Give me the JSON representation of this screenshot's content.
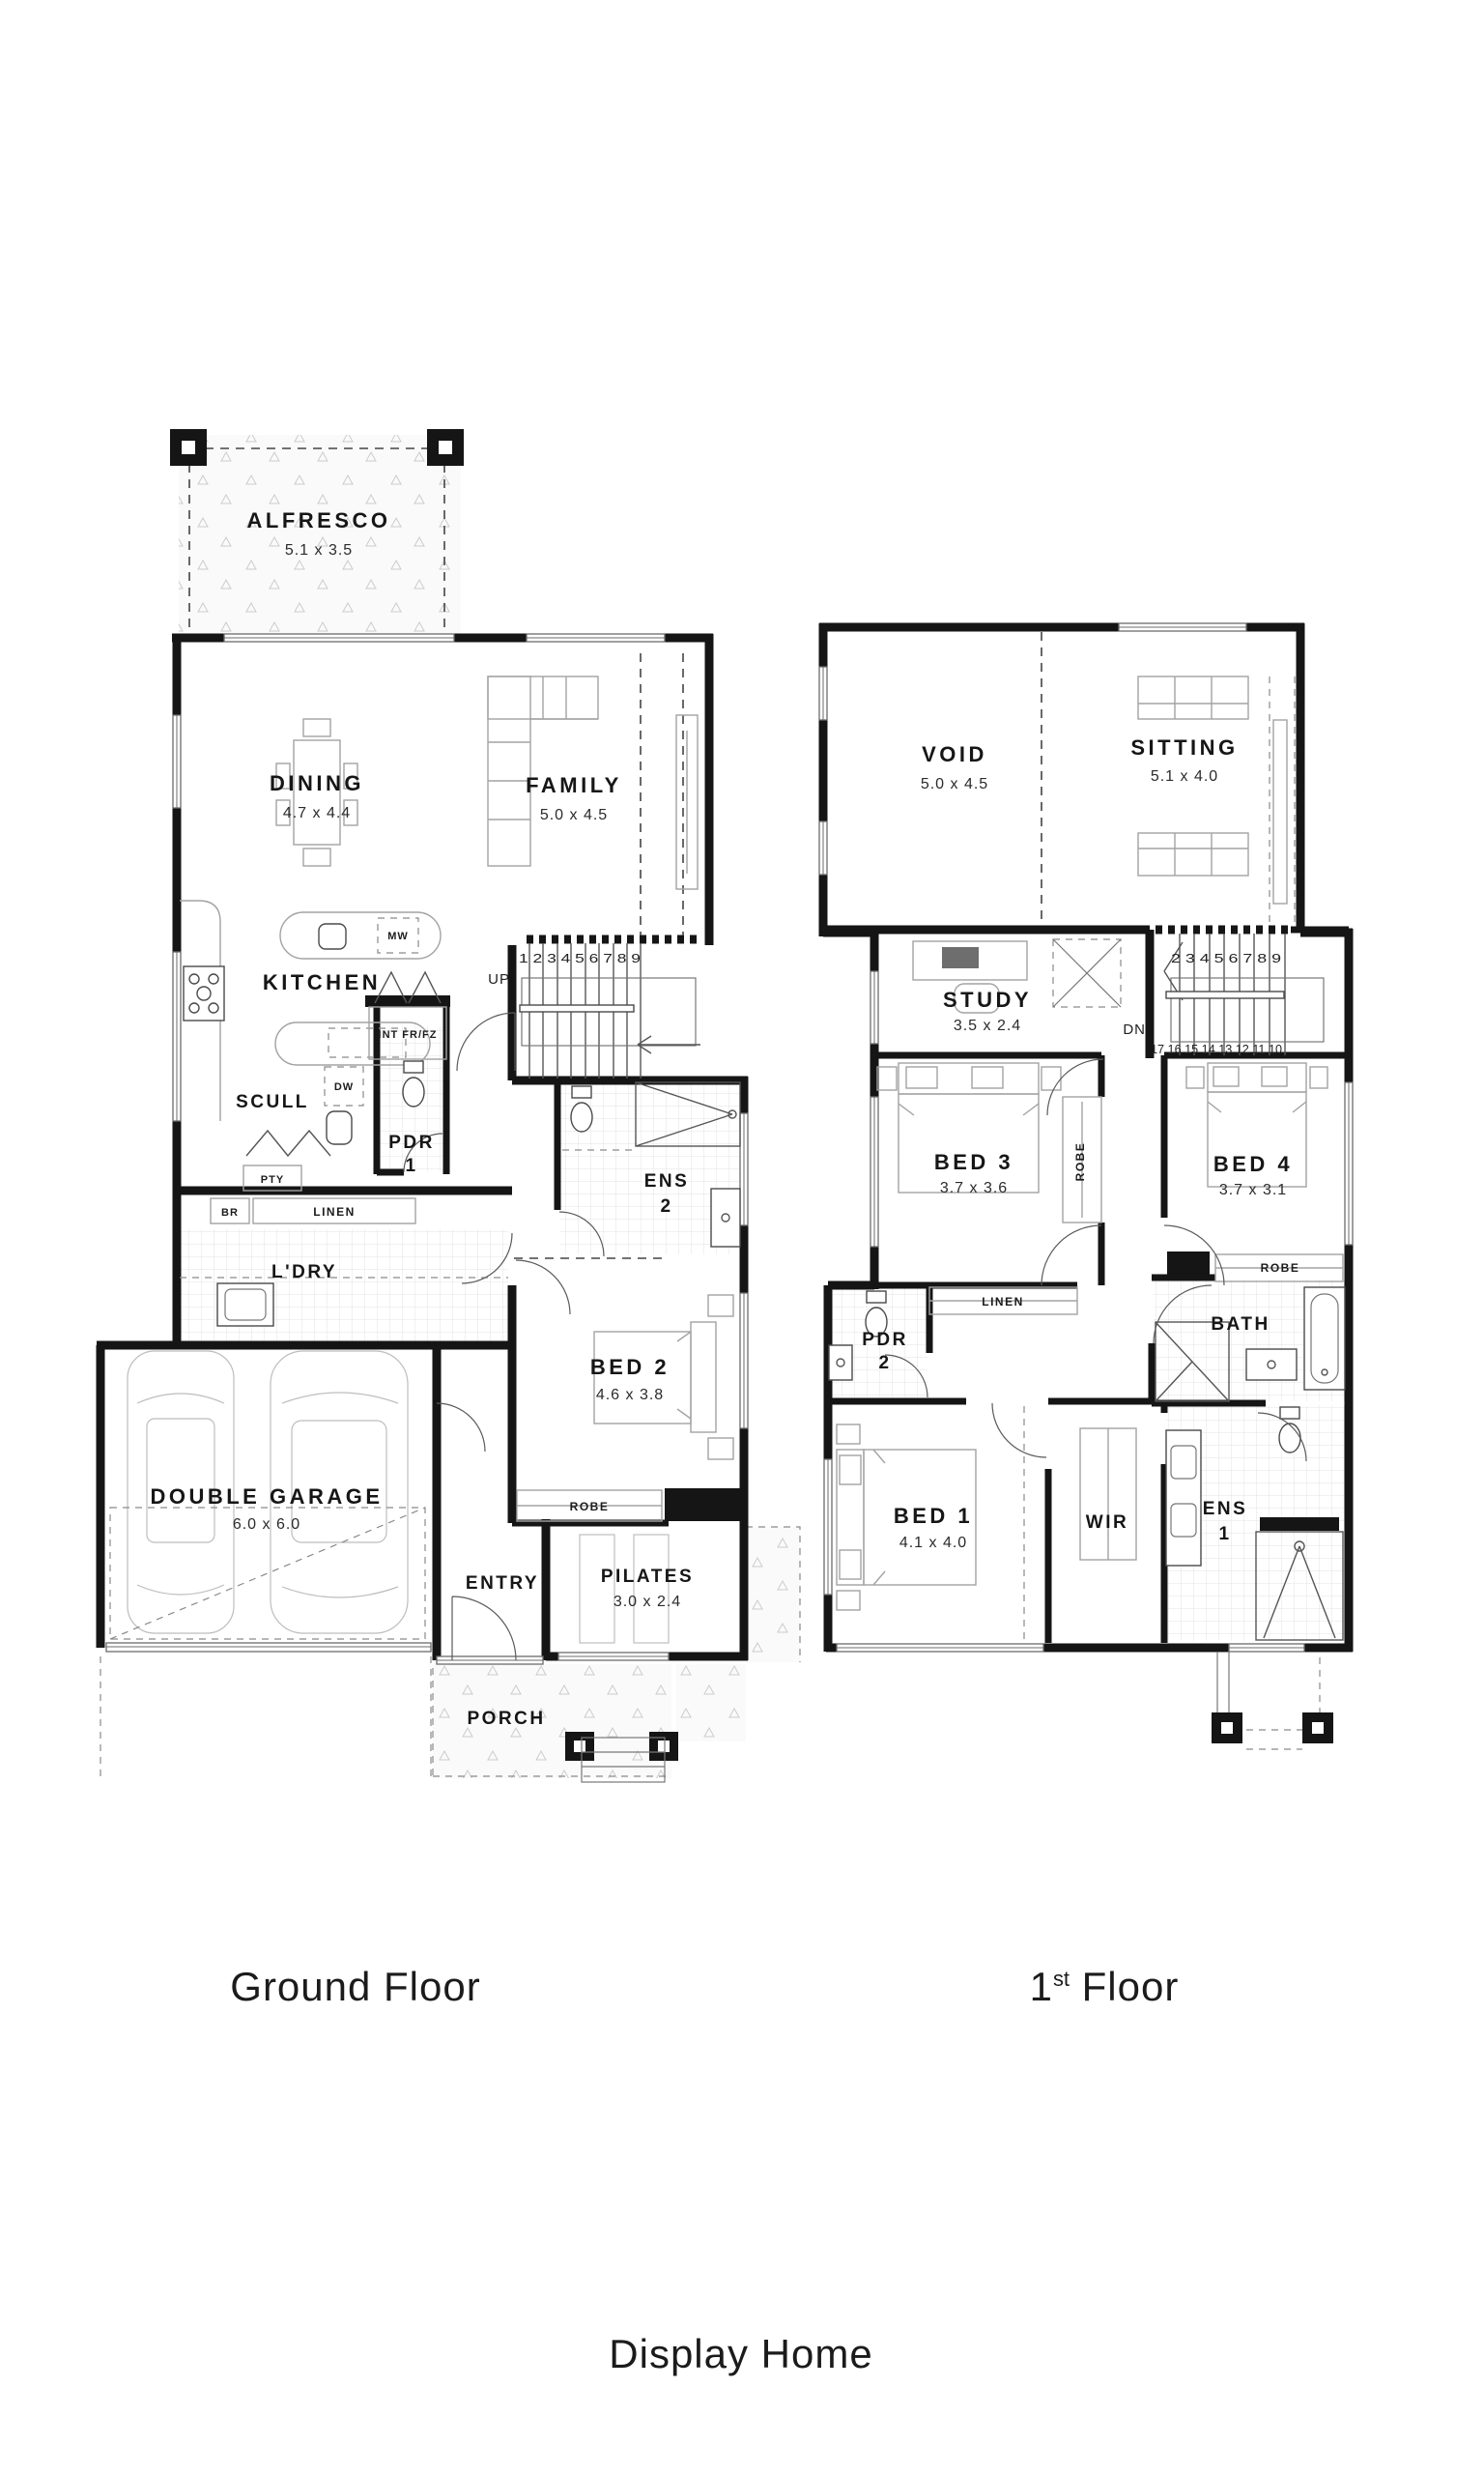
{
  "ground_floor": {
    "caption": "Ground Floor",
    "rooms": {
      "alfresco": {
        "name": "ALFRESCO",
        "dims": "5.1 x 3.5"
      },
      "dining": {
        "name": "DINING",
        "dims": "4.7 x 4.4"
      },
      "family": {
        "name": "FAMILY",
        "dims": "5.0 x 4.5"
      },
      "kitchen": {
        "name": "KITCHEN"
      },
      "scull": {
        "name": "SCULL"
      },
      "pdr1": {
        "name": "PDR",
        "number": "1"
      },
      "ens2": {
        "name": "ENS",
        "number": "2"
      },
      "ldry": {
        "name": "L'DRY"
      },
      "bed2": {
        "name": "BED 2",
        "dims": "4.6 x 3.8"
      },
      "garage": {
        "name": "DOUBLE GARAGE",
        "dims": "6.0 x 6.0"
      },
      "entry": {
        "name": "ENTRY"
      },
      "pilates": {
        "name": "PILATES",
        "dims": "3.0 x 2.4"
      },
      "porch": {
        "name": "PORCH"
      }
    },
    "fixtures": {
      "mw": "MW",
      "dw": "DW",
      "int_fridge": "INT FR/FZ",
      "pty": "PTY",
      "br": "BR",
      "linen": "LINEN",
      "robe": "ROBE"
    },
    "stairs": {
      "direction": "UP",
      "treads": "1 2 3 4 5 6 7 8 9"
    }
  },
  "first_floor": {
    "caption_number": "1",
    "caption_ordinal": "st",
    "caption_word": "Floor",
    "rooms": {
      "void": {
        "name": "VOID",
        "dims": "5.0 x 4.5"
      },
      "sitting": {
        "name": "SITTING",
        "dims": "5.1 x 4.0"
      },
      "study": {
        "name": "STUDY",
        "dims": "3.5 x 2.4"
      },
      "bed3": {
        "name": "BED 3",
        "dims": "3.7 x 3.6"
      },
      "bed4": {
        "name": "BED 4",
        "dims": "3.7 x 3.1"
      },
      "bath": {
        "name": "BATH"
      },
      "pdr2": {
        "name": "PDR",
        "number": "2"
      },
      "bed1": {
        "name": "BED 1",
        "dims": "4.1 x 4.0"
      },
      "wir": {
        "name": "WIR"
      },
      "ens1": {
        "name": "ENS",
        "number": "1"
      }
    },
    "fixtures": {
      "robe_bed3": "ROBE",
      "robe_bed4": "ROBE",
      "linen": "LINEN"
    },
    "stairs": {
      "direction": "DN",
      "treads_upper": "2 3 4 5 6 7 8 9",
      "treads_lower": "17 16 15 14 13 12 11 10"
    }
  },
  "footer": {
    "caption": "Display Home"
  }
}
